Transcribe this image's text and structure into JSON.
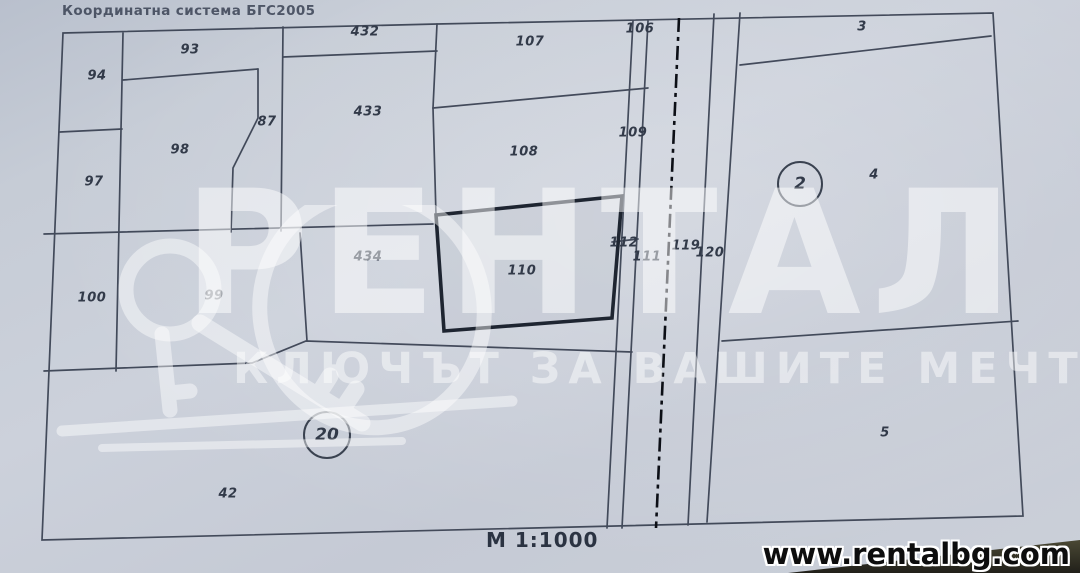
{
  "header": {
    "coordinate_system_label": "Координатна система БГС2005"
  },
  "footer": {
    "scale_label": "М 1:1000",
    "website": "www.rentalbg.com"
  },
  "watermark": {
    "brand": "РЕНТАЛ",
    "slogan": "КЛЮЧЪТ ЗА ВАШИТЕ МЕЧТИ",
    "icon": "key-icon"
  },
  "colors": {
    "paper": "#c6ccd6",
    "line": "#333b4c",
    "highlight_line": "#1e2531",
    "centerline": "#0c0f16",
    "label": "#323a49",
    "watermark_white": "rgba(255,255,255,0.5)",
    "banner_dark": "#3a392a"
  },
  "map": {
    "scale": "1:1000",
    "highlighted_parcel": "110",
    "parcel_labels": [
      {
        "label": "94",
        "x": 97,
        "y": 76
      },
      {
        "label": "93",
        "x": 190,
        "y": 50
      },
      {
        "label": "432",
        "x": 365,
        "y": 32
      },
      {
        "label": "107",
        "x": 530,
        "y": 42
      },
      {
        "label": "106",
        "x": 640,
        "y": 29
      },
      {
        "label": "3",
        "x": 862,
        "y": 27
      },
      {
        "label": "97",
        "x": 94,
        "y": 182
      },
      {
        "label": "98",
        "x": 180,
        "y": 150
      },
      {
        "label": "87",
        "x": 267,
        "y": 122
      },
      {
        "label": "433",
        "x": 368,
        "y": 112
      },
      {
        "label": "108",
        "x": 524,
        "y": 152
      },
      {
        "label": "109",
        "x": 633,
        "y": 133
      },
      {
        "label": "4",
        "x": 874,
        "y": 175
      },
      {
        "label": "100",
        "x": 92,
        "y": 298
      },
      {
        "label": "99",
        "x": 214,
        "y": 296
      },
      {
        "label": "434",
        "x": 368,
        "y": 257
      },
      {
        "label": "110",
        "x": 522,
        "y": 271
      },
      {
        "label": "112",
        "x": 624,
        "y": 243
      },
      {
        "label": "111",
        "x": 647,
        "y": 257
      },
      {
        "label": "119",
        "x": 686,
        "y": 246
      },
      {
        "label": "120",
        "x": 710,
        "y": 253
      },
      {
        "label": "42",
        "x": 228,
        "y": 494
      },
      {
        "label": "5",
        "x": 885,
        "y": 433
      }
    ],
    "circled_labels": [
      {
        "label": "2",
        "x": 800,
        "y": 184,
        "d": 46
      },
      {
        "label": "20",
        "x": 327,
        "y": 435,
        "d": 48
      }
    ]
  }
}
